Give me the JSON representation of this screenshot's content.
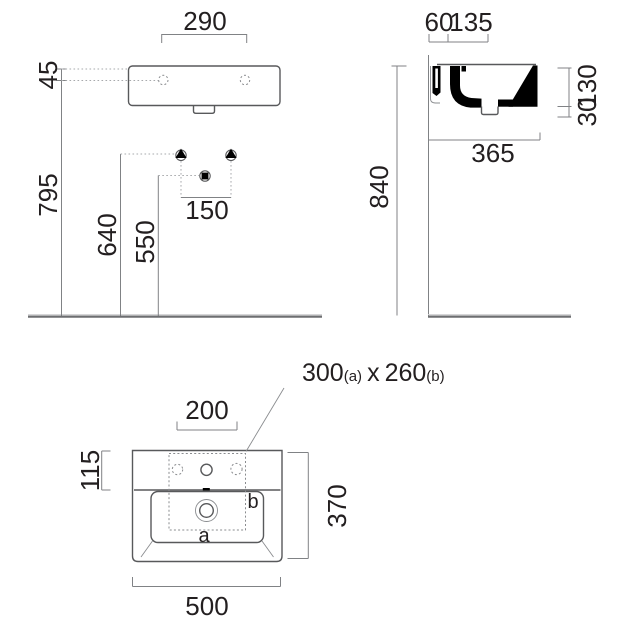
{
  "meta": {
    "description": "Wall-hung washbasin technical dimension drawing, three views",
    "line_color": "#808285",
    "object_line_color": "#58595b",
    "section_fill_color": "#000000",
    "text_color": "#231f20",
    "background_color": "#ffffff"
  },
  "front_view": {
    "dim_tap_hole_spacing": "290",
    "dim_rim_to_tap_axis": "45",
    "dim_tap_axis_to_floor": "795",
    "dim_bracket_height": "640",
    "dim_waste_height": "550",
    "dim_bracket_spacing": "150"
  },
  "side_view": {
    "dim_hole_offset": "60",
    "dim_hole_depth": "135",
    "dim_basin_height": "130",
    "dim_apron_drop": "30",
    "dim_depth": "365",
    "dim_rim_to_floor": "840"
  },
  "plan_view": {
    "cutout_a_value": "300",
    "cutout_a_suffix": "(a)",
    "cutout_separator": "x",
    "cutout_b_value": "260",
    "cutout_b_suffix": "(b)",
    "dim_tap_spacing": "200",
    "dim_tap_setback": "115",
    "dim_depth": "370",
    "dim_width": "500",
    "marker_a": "a",
    "marker_b": "b"
  }
}
